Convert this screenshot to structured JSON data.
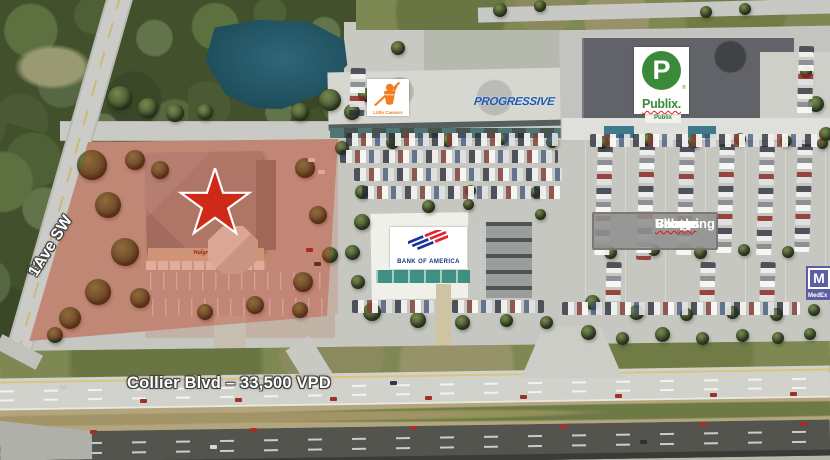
{
  "page": {
    "type": "aerial-site-map"
  },
  "annotations": {
    "street_left": {
      "number": "11",
      "ordinal": "th",
      "suffix": " Ave SW"
    },
    "street_bottom": "Collier Blvd – 33,500 VPD",
    "center_label": {
      "line1_word1": "Brooks",
      "line1_word2": "Village",
      "line2_word1": "Shopping",
      "line2_word2": "Center"
    }
  },
  "logos": {
    "little_caesars": {
      "wordmark": "Little Caesars",
      "color": "#f47b20"
    },
    "progressive": {
      "wordmark": "PROGRESSIVE",
      "color": "#1d5bb0"
    },
    "publix": {
      "monogram": "P",
      "wordmark": "Publix.",
      "registered": "®",
      "storefront_sign": "Publix",
      "color": "#3a8a3a"
    },
    "bank_of_america": {
      "wordmark": "BANK OF AMERICA",
      "color": "#14357f",
      "flag_blue": "#16339c",
      "flag_red": "#e0252e"
    },
    "medexpress": {
      "monogram": "M",
      "wordmark": "MedEx",
      "color": "#5d5ea1"
    }
  },
  "subject_property": {
    "marker": "star",
    "marker_color": "#cf2a18",
    "overlay_color": "rgba(193,42,20,0.32)",
    "building_sign": "Walgreens"
  }
}
